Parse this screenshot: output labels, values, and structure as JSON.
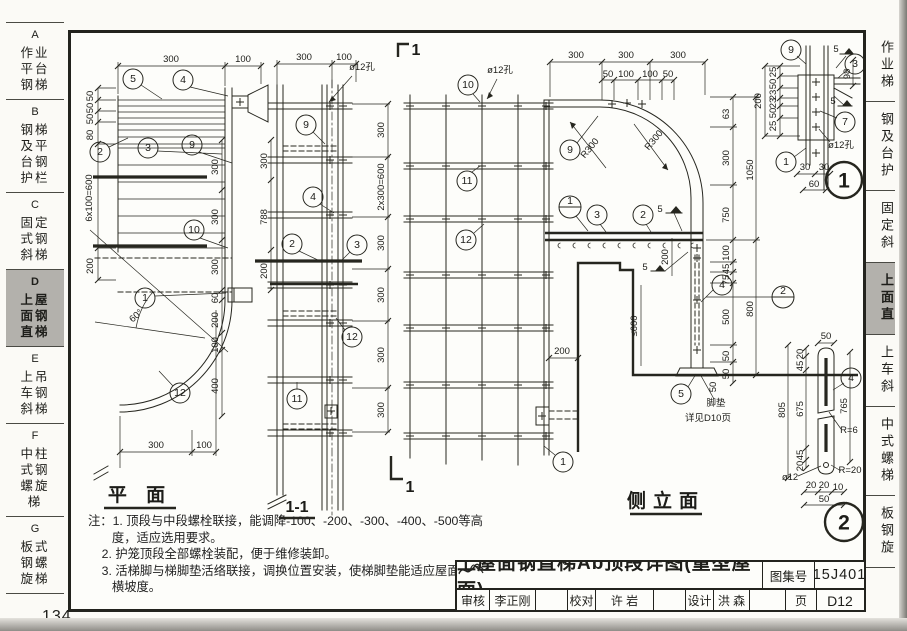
{
  "page": {
    "number": "134"
  },
  "sidebar": {
    "items": [
      {
        "letter": "A",
        "label": "作业平台钢梯"
      },
      {
        "letter": "B",
        "label": "钢梯及平台钢护栏"
      },
      {
        "letter": "C",
        "label": "固定式钢斜梯"
      },
      {
        "letter": "D",
        "label": "上屋面钢直梯"
      },
      {
        "letter": "E",
        "label": "上吊车钢斜梯"
      },
      {
        "letter": "F",
        "label": "中柱式钢螺旋梯"
      },
      {
        "letter": "G",
        "label": "板式钢螺旋梯"
      }
    ]
  },
  "sidebar_right": {
    "items": [
      "作业梯",
      "钢及台护",
      "固定斜",
      "上面直",
      "上车斜",
      "中式螺梯",
      "板钢旋"
    ]
  },
  "plan": {
    "label": "平 面",
    "angle": "60°",
    "dims": [
      "300",
      "100",
      "50",
      "50",
      "50",
      "80",
      "6x100=600",
      "200",
      "300",
      "300",
      "300",
      "60",
      "200",
      "100",
      "400",
      "300",
      "100"
    ],
    "callouts": [
      "5",
      "4",
      "2",
      "3",
      "9",
      "10",
      "1",
      "12"
    ]
  },
  "sec": {
    "label": "1-1",
    "hole": "ø12孔",
    "dims": [
      "300",
      "100",
      "300",
      "788",
      "200",
      "300",
      "2x300=600",
      "300",
      "300",
      "300",
      "300"
    ],
    "callouts": [
      "9",
      "4",
      "2",
      "3",
      "12",
      "11"
    ]
  },
  "elev": {
    "label": "侧立面",
    "cut": "1",
    "hole": "ø12孔",
    "weld": "5",
    "weld2": "5",
    "r1": "R300",
    "r2": "R300",
    "pad_line1": "脚垫",
    "pad_line2": "详见D10页",
    "dims": [
      "300",
      "300",
      "300",
      "50",
      "100",
      "100",
      "50",
      "63",
      "300",
      "750",
      "100",
      "45",
      "75",
      "500",
      "50",
      "50",
      "1050",
      "800",
      "200",
      "200",
      "≤600",
      "50"
    ],
    "callouts": [
      "10",
      "11",
      "12",
      "9",
      "3",
      "2",
      "4",
      "5",
      "1"
    ],
    "refs": [
      "1",
      "2"
    ]
  },
  "d1": {
    "num": "1",
    "hole": "ø12孔",
    "weld1": "5",
    "weld2": "5",
    "dims": [
      "25",
      "50",
      "23",
      "23",
      "50",
      "25",
      "200",
      "98",
      "30",
      "30",
      "60"
    ],
    "callouts": [
      "9",
      "3",
      "7",
      "1"
    ]
  },
  "d2": {
    "num": "2",
    "dims": [
      "50",
      "20",
      "45",
      "675",
      "45",
      "20",
      "805",
      "765",
      "R=6",
      "R=20",
      "ø12",
      "20",
      "20",
      "10",
      "50"
    ],
    "callout": "4"
  },
  "notes": {
    "lines": [
      "注：1. 顶段与中段螺栓联接，能调降-100、-200、-300、-400、-500等高",
      "       度，适应选用要求。",
      "    2. 护笼顶段全部螺栓装配，便于维修装卸。",
      "    3. 活梯脚与梯脚垫活络联接，调换位置安装，使梯脚垫能适应屋面纵、",
      "       横坡度。"
    ]
  },
  "titleblock": {
    "title": "上屋面钢直梯Ab顶段详图(重型屋面)",
    "atlas_label": "图集号",
    "atlas_no": "15J401",
    "page_label": "页",
    "page_no": "D12",
    "cells": [
      {
        "label": "审核",
        "name": "李正刚"
      },
      {
        "label": "校对",
        "name": "许 岩"
      },
      {
        "label": "设计",
        "name": "洪 森"
      }
    ]
  }
}
